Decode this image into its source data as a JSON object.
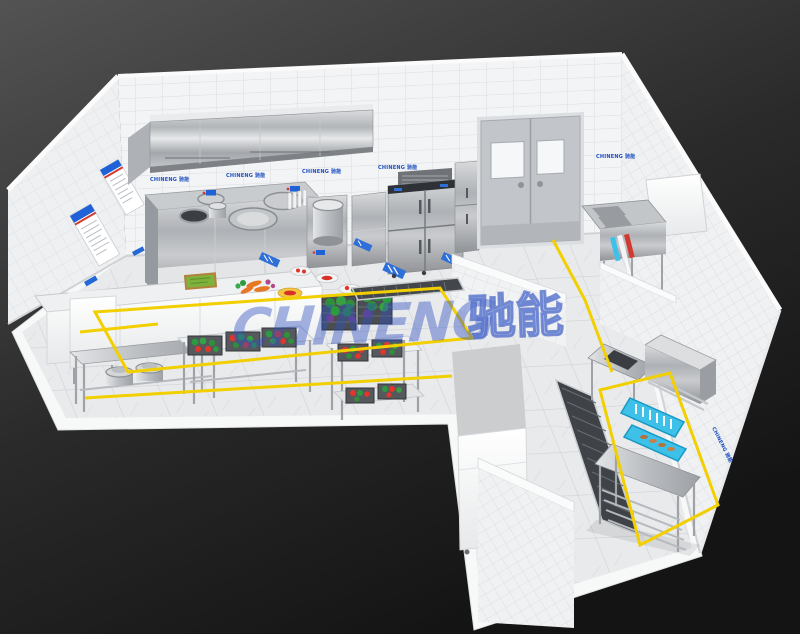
{
  "scene": {
    "title": "commercial-kitchen-3d-render",
    "brand": {
      "watermark_latin": "CHINENG",
      "watermark_cn": "驰能",
      "wall_label_text": "CHINENG 驰能"
    },
    "colors": {
      "background_top": "#535353",
      "background_bottom": "#161616",
      "watermark_blue": "#2e51c0",
      "watermark_cn_fill": "#b9c6ea",
      "label_blue": "#1d4fc0",
      "floor_marking_yellow": "#f2cf00",
      "stainless_steel": "#b9bcc0",
      "tile_white": "#f4f5f6",
      "dish_rack_cyan": "#3ec1e8",
      "vegetable_green": "#2c9b3f",
      "vegetable_red": "#e2362b",
      "carrot_orange": "#e87722",
      "door_gray": "#c2c5c9"
    },
    "equipment": {
      "range_hood": "exhaust-hood",
      "wok_range": "double-wok-range",
      "stock_pot": "stock-pot-boiler",
      "fridge": "four-door-refrigerator",
      "double_door": "double-swing-door",
      "sink": "triple-basin-sink",
      "prep_tables": "prep-tables-with-vegetables",
      "dishwasher": "hood-type-dishwasher",
      "floor_drain": "floor-drain-grate",
      "posters": "wall-safety-posters"
    }
  }
}
